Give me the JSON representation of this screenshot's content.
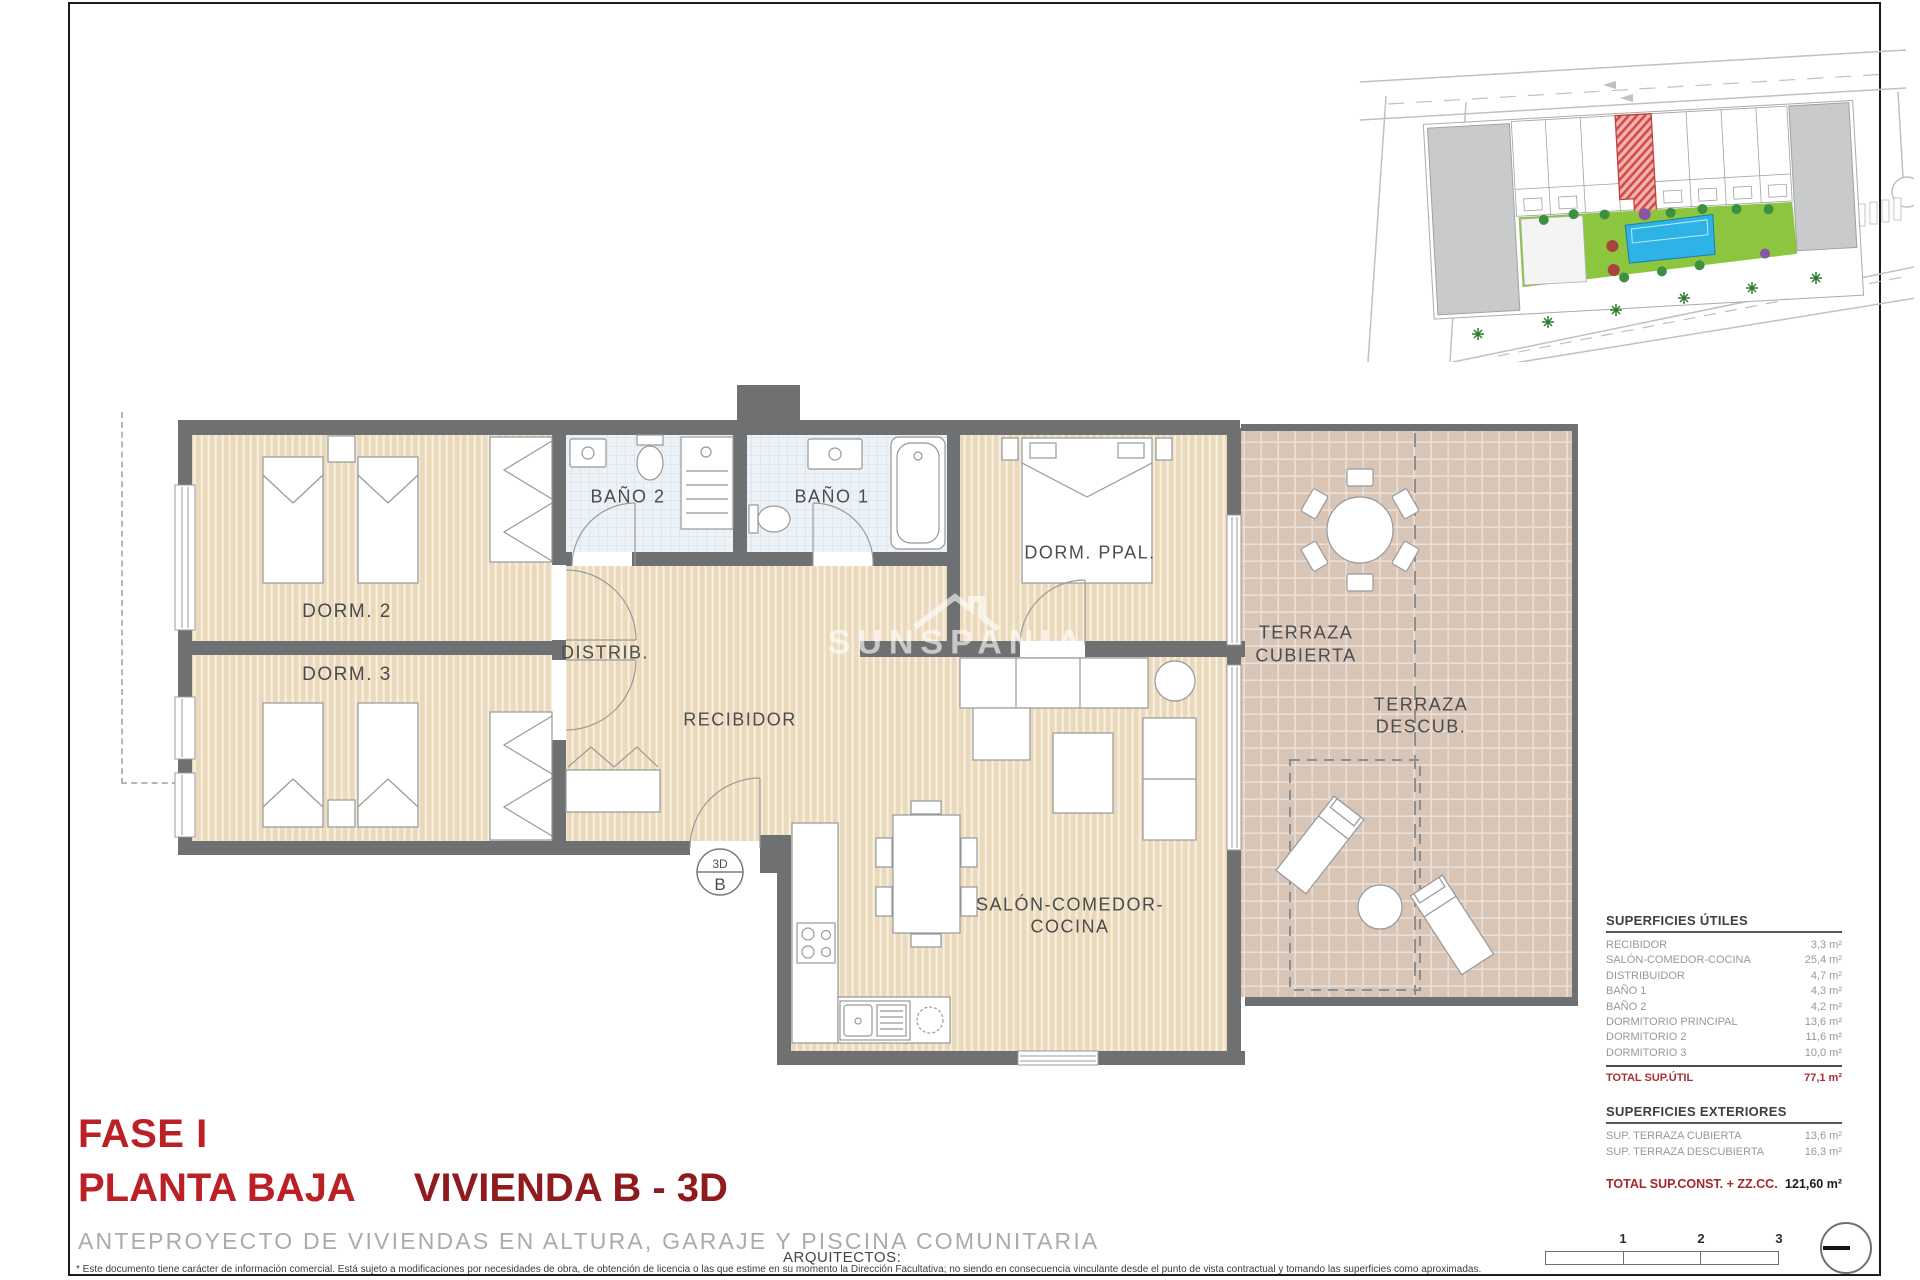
{
  "document": {
    "phase": "FASE I",
    "floor": "PLANTA BAJA",
    "unit": "VIVIENDA B - 3D",
    "subtitle": "ANTEPROYECTO DE VIVIENDAS EN ALTURA, GARAJE Y PISCINA COMUNITARIA",
    "architects_label": "ARQUITECTOS:",
    "disclaimer": "* Este documento tiene carácter de información comercial. Está sujeto a modificaciones por necesidades de obra, de obtención de licencia o las que estime en su momento la Dirección Facultativa; no siendo en consecuencia vinculante desde el punto de vista contractual y tomando las superficies como aproximadas.",
    "watermark": "SUNSPANIA"
  },
  "plan": {
    "marker": {
      "top": "3D",
      "bottom": "B"
    },
    "rooms": {
      "dorm2": "DORM. 2",
      "dorm3": "DORM. 3",
      "bano2": "BAÑO 2",
      "bano1": "BAÑO 1",
      "dorm_ppal": "DORM. PPAL.",
      "distrib": "DISTRIB.",
      "recibidor": "RECIBIDOR",
      "salon1": "SALÓN-COMEDOR-",
      "salon2": "COCINA",
      "terraza_cub1": "TERRAZA",
      "terraza_cub2": "CUBIERTA",
      "terraza_desc1": "TERRAZA",
      "terraza_desc2": "DESCUB."
    }
  },
  "areas": {
    "utiles": {
      "heading": "SUPERFICIES ÚTILES",
      "rows": [
        {
          "label": "RECIBIDOR",
          "value": "3,3 m²"
        },
        {
          "label": "SALÓN-COMEDOR-COCINA",
          "value": "25,4 m²"
        },
        {
          "label": "DISTRIBUIDOR",
          "value": "4,7 m²"
        },
        {
          "label": "BAÑO 1",
          "value": "4,3 m²"
        },
        {
          "label": "BAÑO 2",
          "value": "4,2 m²"
        },
        {
          "label": "DORMITORIO PRINCIPAL",
          "value": "13,6 m²"
        },
        {
          "label": "DORMITORIO 2",
          "value": "11,6 m²"
        },
        {
          "label": "DORMITORIO 3",
          "value": "10,0 m²"
        }
      ],
      "total": {
        "label": "TOTAL SUP.ÚTIL",
        "value": "77,1 m²"
      }
    },
    "exteriores": {
      "heading": "SUPERFICIES EXTERIORES",
      "rows": [
        {
          "label": "SUP. TERRAZA CUBIERTA",
          "value": "13,6 m²"
        },
        {
          "label": "SUP. TERRAZA DESCUBIERTA",
          "value": "16,3 m²"
        }
      ]
    },
    "total_const": {
      "label": "TOTAL SUP.CONST. + ZZ.CC.",
      "value": "121,60 m²"
    }
  },
  "scale_bar": {
    "ticks": [
      "1",
      "2",
      "3"
    ]
  },
  "colors": {
    "title_red": "#bb2026",
    "dark_red": "#8f1b1f",
    "wall_gray": "#6f7072",
    "floor_beige": "#ebd9bb",
    "terrace_pink": "#d9c5b6",
    "bath_blue": "#edf2f7",
    "pool_blue": "#2eb3e7",
    "garden_green": "#8cc63f",
    "highlight_red_hatch": "#d14b47"
  }
}
